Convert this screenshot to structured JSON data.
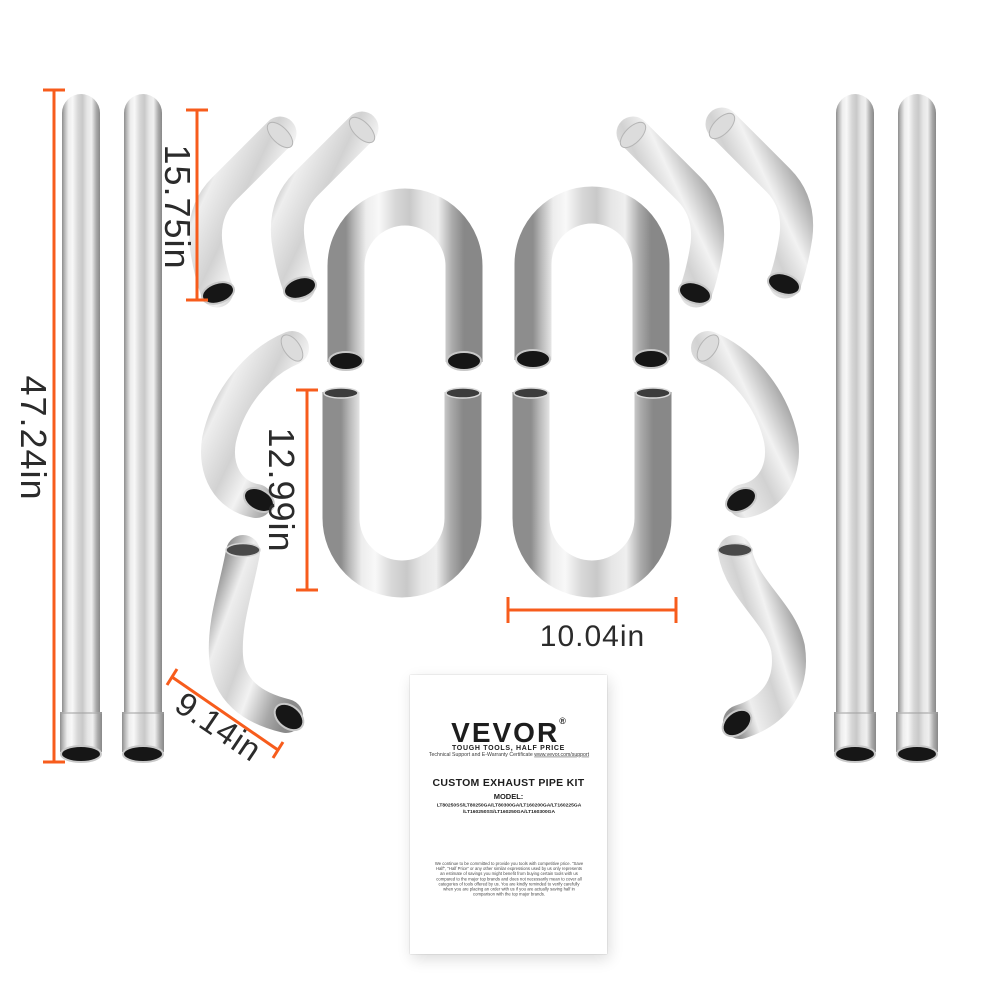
{
  "dimensions": {
    "pipe_straight_length": "47.24in",
    "pipe_45_length": "15.75in",
    "pipe_u_height": "12.99in",
    "pipe_u_width": "10.04in",
    "pipe_90_length": "9.14in"
  },
  "card": {
    "brand": "VEVOR",
    "registered_mark": "®",
    "tagline": "TOUGH TOOLS, HALF PRICE",
    "support_prefix": "Technical Support and E-Warranty Certificate ",
    "support_url": "www.vevor.com/support",
    "product_title": "CUSTOM EXHAUST PIPE KIT",
    "model_label": "MODEL:",
    "model_line1": "LT80250SS/LT80250GA/LT80300GA/LT160200GA/LT160225GA",
    "model_line2": "/LT160250SS/LT160250GA/LT160300GA",
    "disclaimer": "We continue to be committed to provide you tools with competitive price. \"Save Half\", \"Half Price\" or any other similar expressions used by us only represents an estimate of savings you might benefit from buying certain tools with us compared to the major top brands and does not necessarily mean to cover all categories of tools offered by us. You are kindly reminded to verify carefully when you are placing an order with us if you are actually saving half in comparison with the top major brands."
  },
  "colors": {
    "dimension_line": "#f75c1c",
    "annotation_text": "#2b2b2b",
    "pipe_highlight": "#f4f4f4",
    "pipe_shadow": "#8a8a8a",
    "opening": "#161616"
  }
}
